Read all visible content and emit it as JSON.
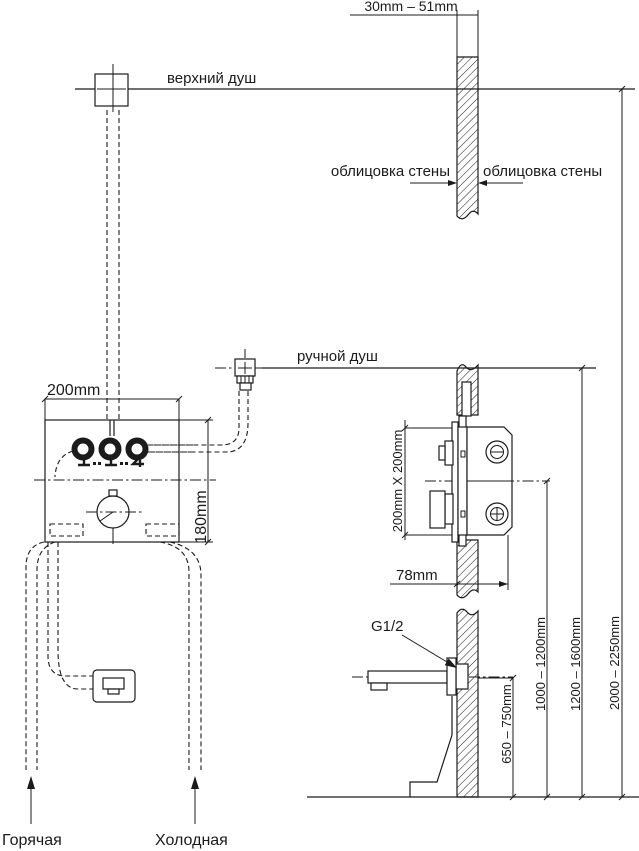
{
  "colors": {
    "line": "#1b1b1b",
    "background": "#ffffff"
  },
  "top_dimension": {
    "label": "30mm – 51mm"
  },
  "fixtures": {
    "overhead_shower": "верхний душ",
    "hand_shower": "ручной душ",
    "wall_cladding_left": "облицовка стены",
    "wall_cladding_right": "облицовка стены",
    "thread_size": "G1/2",
    "hot_supply": "Горячая",
    "cold_supply": "Холодная"
  },
  "mixer_dimensions": {
    "front_width": "200mm",
    "front_height": "180mm",
    "body_size": "200mm X 200mm",
    "depth": "78mm"
  },
  "mounting_heights": {
    "spout": "650 – 750mm",
    "mixer": "1000 – 1200mm",
    "hand_shower": "1200 – 1600mm",
    "overhead_shower": "2000 – 2250mm"
  }
}
